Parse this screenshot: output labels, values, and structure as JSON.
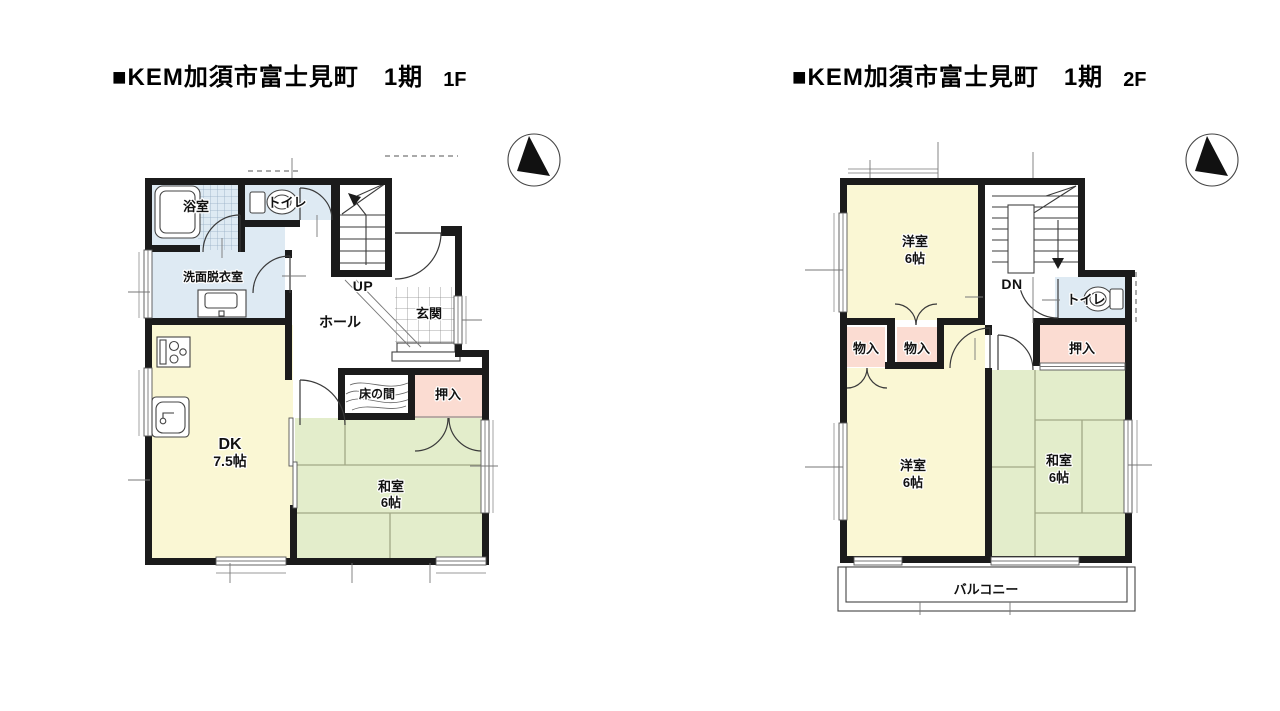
{
  "page": {
    "background": "#ffffff"
  },
  "colors": {
    "wall": "#1b1b1b",
    "room_yellow": "#FAF7D4",
    "tatami_green": "#E3EDCB",
    "closet_pink": "#FBDCD2",
    "wet_area_blue": "#DEEAF3",
    "tatami_line": "#A2A886"
  },
  "plans": {
    "f1": {
      "title": "■KEM加須市富士見町　1期",
      "floor": "1F",
      "labels": {
        "bath": "浴室",
        "toilet": "トイレ",
        "washroom": "洗面脱衣室",
        "hall": "ホール",
        "stairs": "UP",
        "entrance": "玄関",
        "dk_name": "DK",
        "dk_size": "7.5帖",
        "tokonoma": "床の間",
        "closet": "押入",
        "washitsu_name": "和室",
        "washitsu_size": "6帖"
      }
    },
    "f2": {
      "title": "■KEM加須市富士見町　1期",
      "floor": "2F",
      "labels": {
        "west_top_name": "洋室",
        "west_top_size": "6帖",
        "stairs": "DN",
        "toilet": "トイレ",
        "storage1": "物入",
        "storage2": "物入",
        "closet": "押入",
        "west_bottom_name": "洋室",
        "west_bottom_size": "6帖",
        "washitsu_name": "和室",
        "washitsu_size": "6帖",
        "balcony": "バルコニー"
      }
    }
  }
}
